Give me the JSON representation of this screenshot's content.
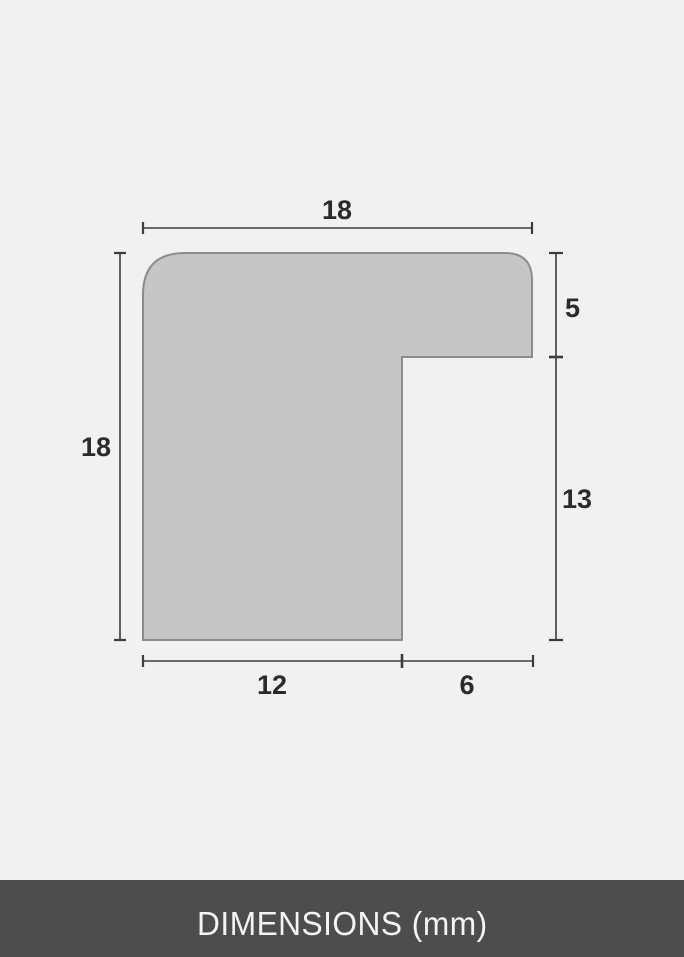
{
  "diagram": {
    "labels": {
      "top_width": "18",
      "left_height": "18",
      "right_upper": "5",
      "right_lower": "13",
      "bottom_left": "12",
      "bottom_right": "6"
    },
    "colors": {
      "background": "#f1f1f1",
      "shape_fill": "#c6c6c6",
      "shape_stroke": "#8c8c8c",
      "dimension_line": "#3c3c3c",
      "label_text": "#2b2b2b",
      "footer_background": "#4d4d4d",
      "footer_text": "#f4f4f4"
    }
  },
  "footer": {
    "label": "DIMENSIONS (mm)"
  }
}
